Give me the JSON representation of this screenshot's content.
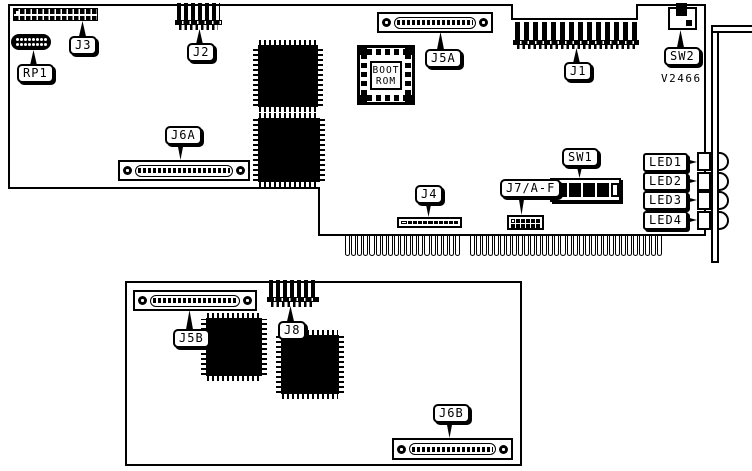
{
  "figure": {
    "part_number": "V2466",
    "ink": "#000000",
    "paper": "#ffffff",
    "description": "Printed circuit board component location diagram, main board with ISA edge connector and bracket, plus daughter board"
  },
  "labels": {
    "rp1": "RP1",
    "j3": "J3",
    "j2": "J2",
    "j5a": "J5A",
    "j1": "J1",
    "sw2": "SW2",
    "j6a": "J6A",
    "j4": "J4",
    "j7af": "J7/A-F",
    "sw1": "SW1",
    "led1": "LED1",
    "led2": "LED2",
    "led3": "LED3",
    "led4": "LED4",
    "j5b": "J5B",
    "j8": "J8",
    "j6b": "J6B",
    "boot_rom_line1": "BOOT",
    "boot_rom_line2": "ROM"
  },
  "components": {
    "rp1_dots": 16,
    "j4_cells": 11,
    "j7_cells": 12,
    "sw1_cells": 5
  },
  "edge_connector": {
    "group1_fingers": 19,
    "group2_fingers": 32
  }
}
